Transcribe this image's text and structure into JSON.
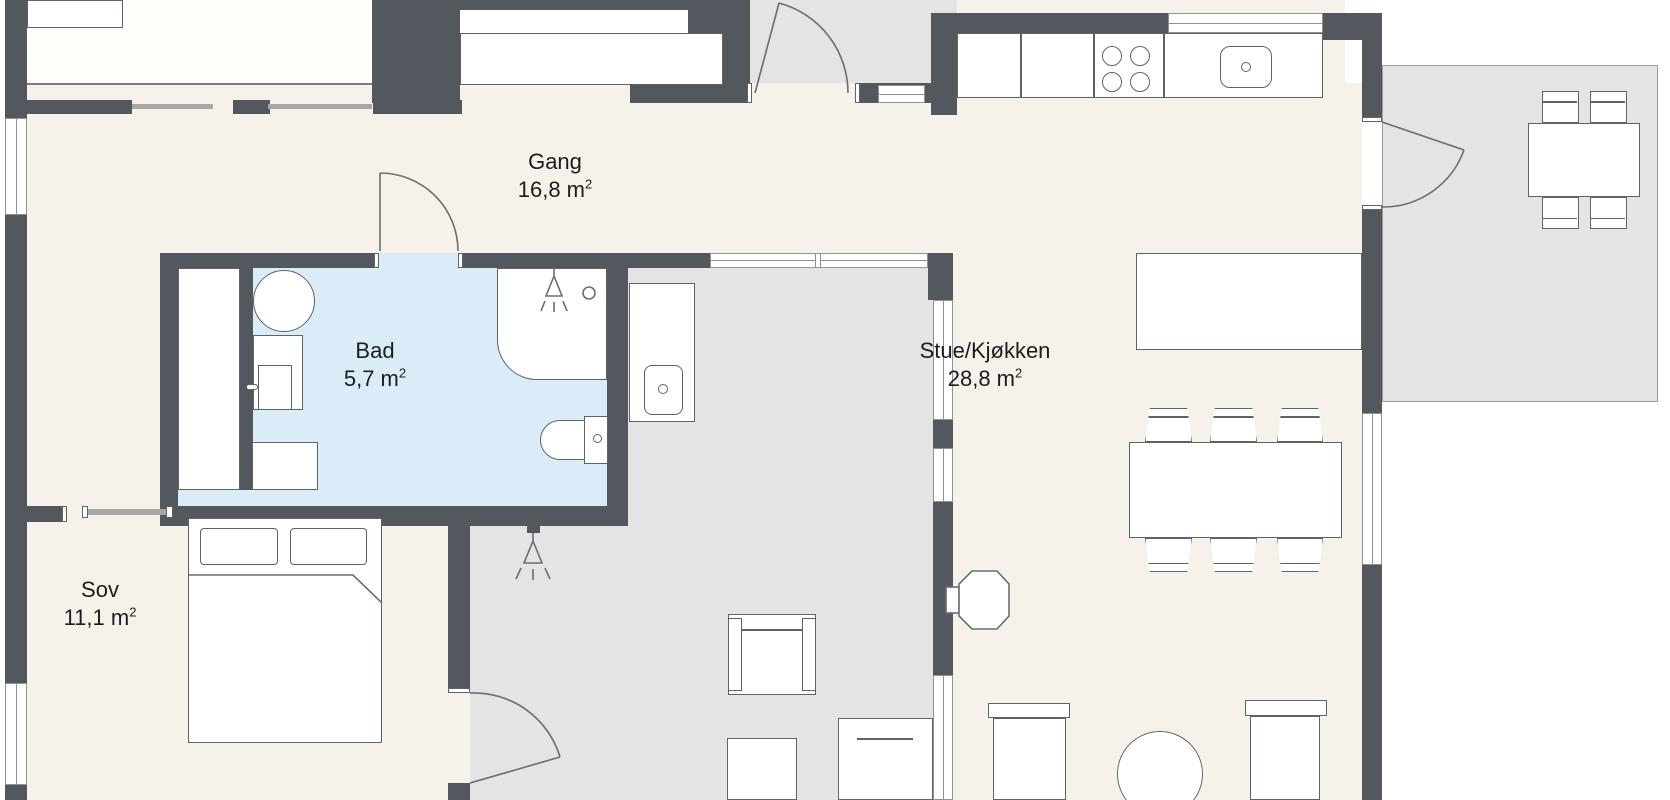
{
  "floorplan": {
    "rooms": [
      {
        "id": "gang",
        "name": "Gang",
        "area_value": "16,8 m",
        "area_sup": "2"
      },
      {
        "id": "bad",
        "name": "Bad",
        "area_value": "5,7 m",
        "area_sup": "2"
      },
      {
        "id": "sov",
        "name": "Sov",
        "area_value": "11,1 m",
        "area_sup": "2"
      },
      {
        "id": "stue-kjokken",
        "name": "Stue/Kjøkken",
        "area_value": "28,8 m",
        "area_sup": "2"
      }
    ],
    "colors": {
      "wall": "#53575e",
      "floor": "#f6f2e9",
      "outdoor": "#e3e4e3",
      "bathroom": "#d9ecf7",
      "line": "#5f6368",
      "window-border": "#8f9294",
      "label-text": "#1c1c1e"
    }
  }
}
